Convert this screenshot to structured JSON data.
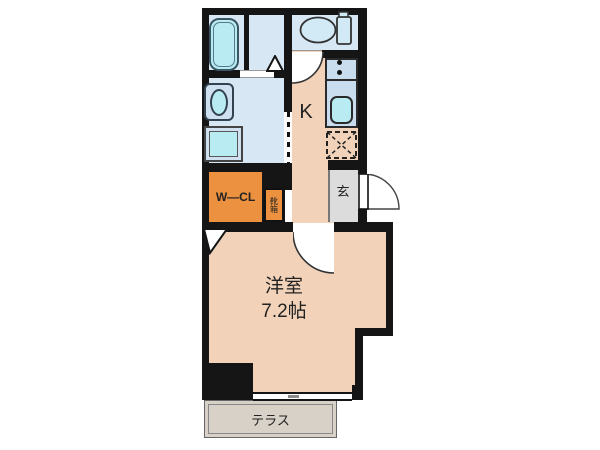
{
  "floorplan": {
    "rooms": {
      "kitchen_label": "K",
      "entrance_label": "玄",
      "walk_in_closet_label": "W—CL",
      "shoe_cabinet_label": "靴箱",
      "main_room_label": "洋室",
      "main_room_size": "7.2帖",
      "terrace_label": "テラス"
    },
    "fixtures": [
      "bathtub",
      "vanity-sink",
      "washing-machine",
      "toilet",
      "kitchen-sink",
      "stove-burners",
      "refrigerator-space"
    ],
    "colors": {
      "wall": "#151515",
      "wet_area_blue": "#d7e7f4",
      "fixture_cyan": "#b9ecf2",
      "counter_blue": "#c9ddef",
      "floor_peach": "#f2d3ba",
      "closet_orange": "#eb9140",
      "entrance_gray": "#dcdcdc",
      "terrace_gray": "#d8d1c8"
    }
  }
}
